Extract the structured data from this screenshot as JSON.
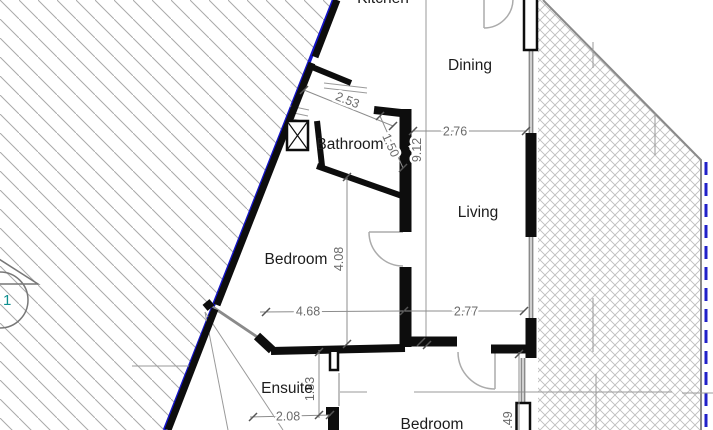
{
  "rooms": {
    "kitchen": "Kitchen",
    "dining": "Dining",
    "bathroom": "Bathroom",
    "living": "Living",
    "bedroom": "Bedroom",
    "ensuite": "Ensuite",
    "bedroom2": "Bedroom"
  },
  "dimensions": {
    "bath_top": "2.53",
    "bath_side": "1.50",
    "plan_height": "9.12",
    "dining_width": "2.76",
    "bedroom_height": "4.08",
    "bedroom_width": "4.68",
    "living_width": "2.77",
    "ensuite_height": "1.83",
    "ensuite_width": "2.08",
    "wall_offset": ".49"
  },
  "markers": {
    "section": "1"
  },
  "colors": {
    "boundary_blue": "#1414c8",
    "wall_black": "#0d0d0d",
    "dimension_gray": "#6b6b6b",
    "hatch_gray": "#a9a9a9"
  }
}
